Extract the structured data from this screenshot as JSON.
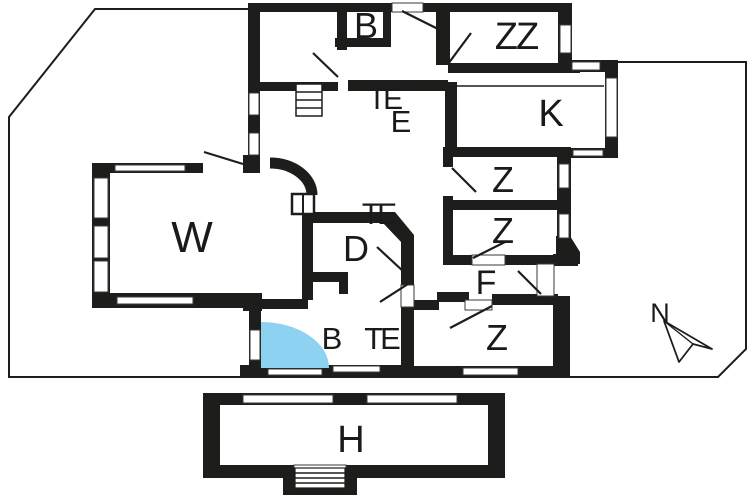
{
  "floorplan": {
    "labels": {
      "b_top": "B",
      "zz": "ZZ",
      "te_top": "TE",
      "e_hall": "E",
      "kitchen": "K",
      "living": "W",
      "z1": "Z",
      "z2": "Z",
      "te_mid": "TE",
      "d_room": "D",
      "f_hall": "F",
      "b_bottom": "B",
      "te_bottom": "TE",
      "z3": "Z",
      "h_building": "H",
      "compass": "N"
    },
    "colors": {
      "wall": "#1d1d1b",
      "entrance_door": "#8dd2f1",
      "background": "#ffffff"
    }
  }
}
